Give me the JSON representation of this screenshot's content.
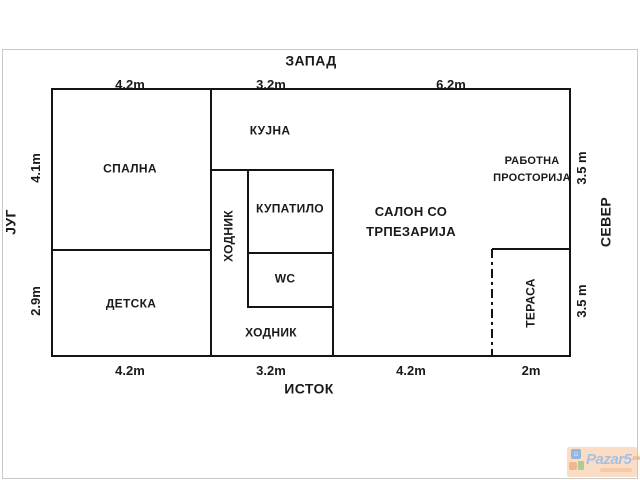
{
  "compass": {
    "west": "ЗАПАД",
    "east": "ИСТОК",
    "south": "ЈУГ",
    "north": "СЕВЕР"
  },
  "dims": {
    "top": [
      "4.2m",
      "3.2m",
      "6.2m"
    ],
    "bottom": [
      "4.2m",
      "3.2m",
      "4.2m",
      "2m"
    ],
    "left": [
      "4.1m",
      "2.9m"
    ],
    "right": [
      "3.5 m",
      "3.5 m"
    ]
  },
  "rooms": {
    "spalna": "СПАЛНА",
    "kujna": "КУЈНА",
    "hodnik_vertical": "ХОДНИК",
    "kupatilo": "КУПАТИЛО",
    "wc": "WC",
    "hodnik_bottom": "ХОДНИК",
    "detska": "ДЕТСКА",
    "salon_line1": "САЛОН СО",
    "salon_line2": "ТРПЕЗАРИЈА",
    "rabotna_line1": "РАБОТНА",
    "rabotna_line2": "ПРОСТОРИЈА",
    "terasa": "ТЕРАСА"
  },
  "watermark": {
    "brand": "Pazar5",
    "tld": ".mk"
  },
  "colors": {
    "wall": "#141414",
    "text": "#1a1a1a",
    "frame_border": "#c9c9c9",
    "logo_bg": "#fbdcc2",
    "logo_brand": "#9dbfe6",
    "logo_tld": "#eaa86c"
  }
}
